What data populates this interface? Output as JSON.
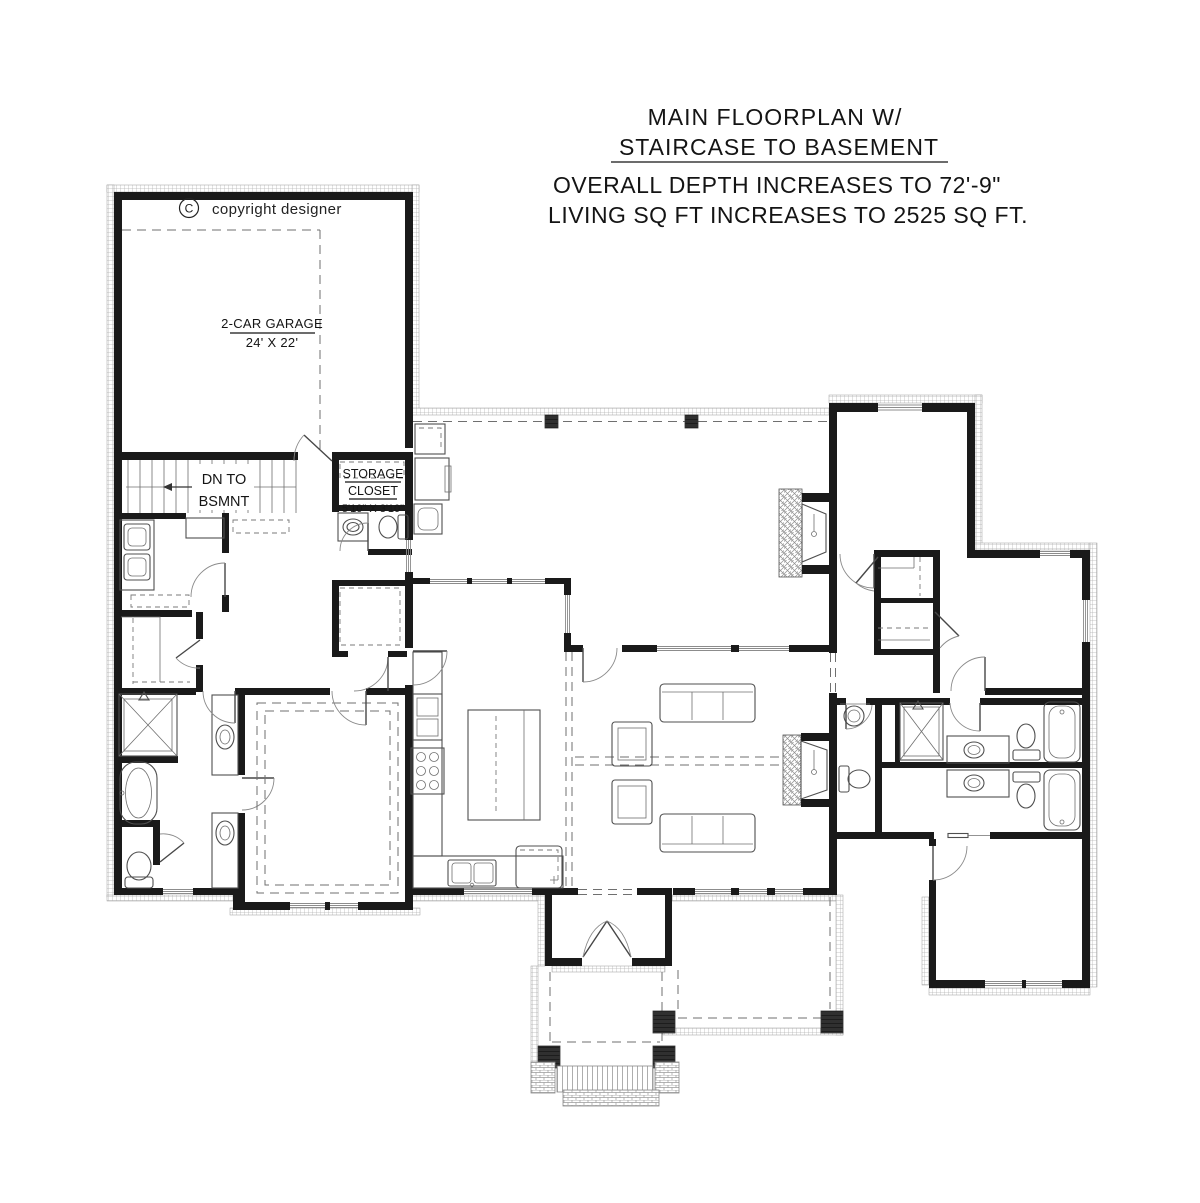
{
  "colors": {
    "background": "#ffffff",
    "walls": "#1a1a1a",
    "fixtures": "#4f4f4f",
    "exterior_hatch": "#b5b5b5"
  },
  "header": {
    "title_line1": "MAIN FLOORPLAN W/",
    "title_line2": "STAIRCASE TO BASEMENT",
    "note_line1": "OVERALL DEPTH INCREASES TO 72'-9\"",
    "note_line2": "LIVING SQ FT INCREASES TO 2525 SQ FT."
  },
  "labels": {
    "copyright_symbol": "C",
    "copyright_text": "copyright designer",
    "garage": {
      "name": "2-CAR GARAGE",
      "dims": "24' X 22'"
    },
    "stairs": {
      "line1": "DN TO",
      "line2": "BSMNT"
    },
    "storage": {
      "line1": "STORAGE",
      "line2": "CLOSET",
      "dims": "5'10\" X 3'10\""
    }
  }
}
